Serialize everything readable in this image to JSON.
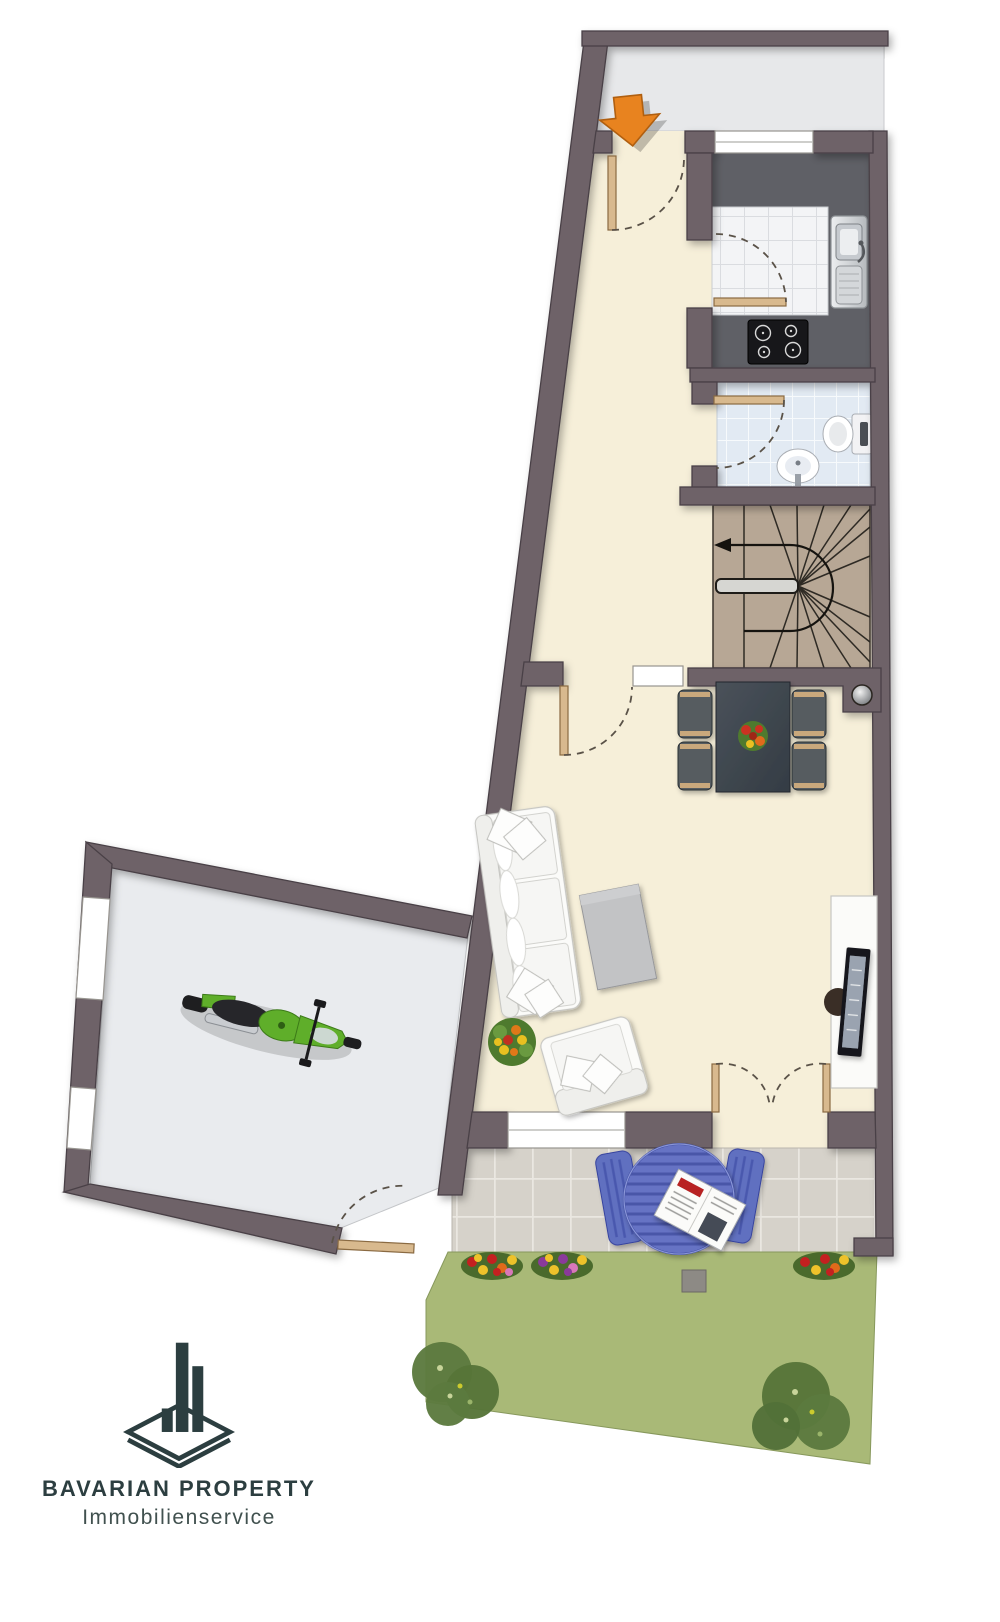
{
  "logo": {
    "title": "BAVARIAN PROPERTY",
    "subtitle": "Immobilienservice"
  },
  "icons": {
    "entrance-arrow-icon": "orange arrow pointing down into entrance door",
    "stair-direction-icon": "black arrow showing stair run, pointing left",
    "logo-icon": "diamond platform with three building bars"
  },
  "colors": {
    "wall": "#6e6267",
    "wall_edge": "#4a4146",
    "floor": "#f6efd9",
    "entry": "#e7e8ea",
    "garage_floor": "#e9ebee",
    "counter": "#5f6066",
    "kitchen_tile": "#f3f4f6",
    "wc_tile": "#e2eaf3",
    "stair": "#b7a795",
    "terrace_tile": "#d6d2ca",
    "lawn": "#a9b977",
    "bush": "#5c7a3e",
    "furniture_blue": "#6673c4",
    "furniture_blue_dark": "#39479e",
    "dining_dark": "#40484f",
    "wood_trim": "#c9a87c",
    "door_wood": "#d8b98e",
    "accent_orange": "#e8831f",
    "logo": "#2c3e40",
    "logo_sub": "#41514f",
    "moto_green": "#5fae2a"
  }
}
